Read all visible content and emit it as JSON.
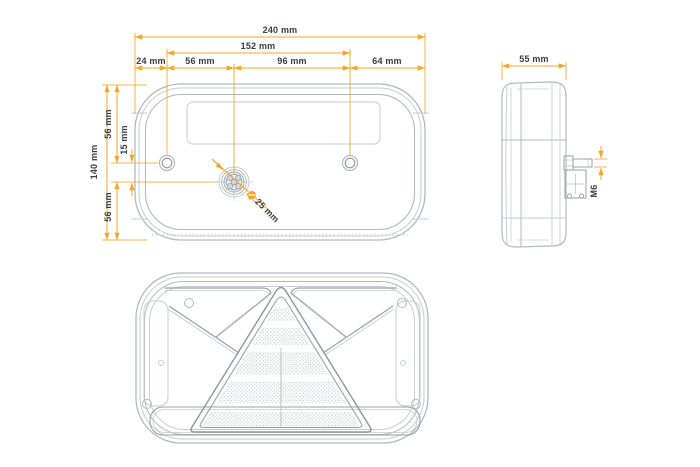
{
  "title": "Trailer rear lamp technical dimension drawing",
  "colors": {
    "accent": "#F5A623",
    "line_light": "#C6CBD0",
    "line_mid": "#A9AFB5",
    "line_dark": "#8F959C",
    "text": "#383D43",
    "background": "#FFFFFF"
  },
  "rear_view": {
    "dim_total_width": "240 mm",
    "dim_mount_span": "152 mm",
    "dim_left_edge_to_screw": "24 mm",
    "dim_screw_to_connector": "56 mm",
    "dim_connector_to_screw": "96 mm",
    "dim_screw_to_right_edge": "64 mm",
    "dim_total_height": "140 mm",
    "dim_top_to_screw": "56 mm",
    "dim_screw_to_connector_vertical": "15 mm",
    "dim_connector_to_bottom": "56 mm",
    "dim_connector_diameter": "25 mm"
  },
  "side_view": {
    "dim_depth": "55 mm",
    "stud_thread": "M6"
  }
}
